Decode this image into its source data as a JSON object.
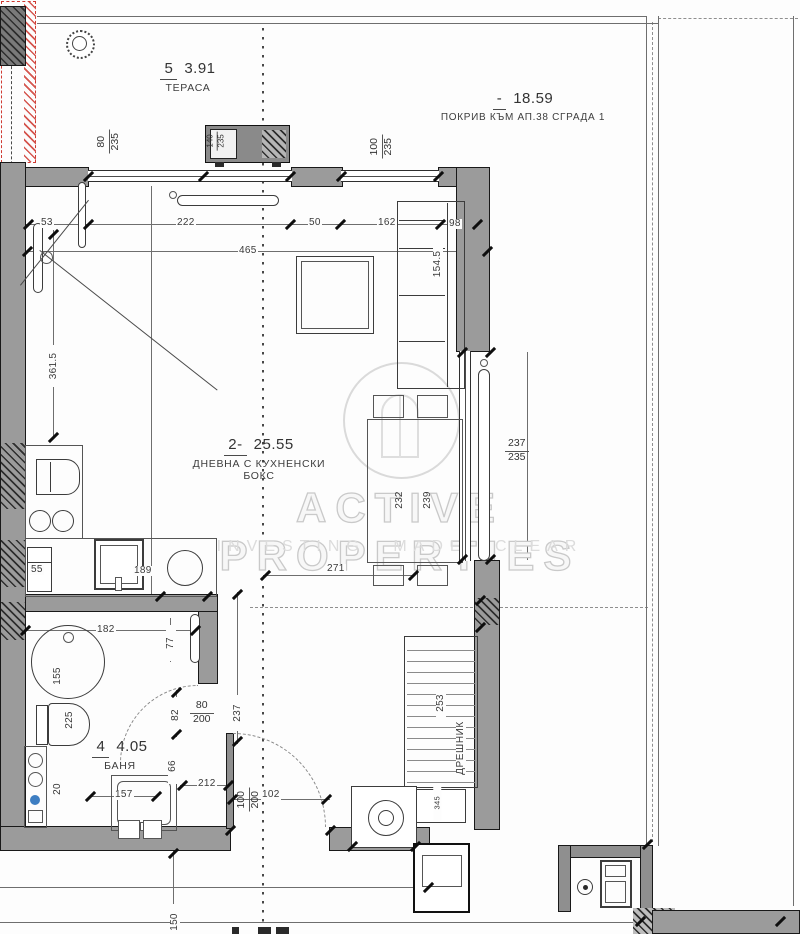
{
  "watermark": {
    "line1": "ACTIVE PROPERTIES",
    "line2": "INVESTING MADE CLEAR"
  },
  "rooms": {
    "terrace": {
      "num": "5",
      "area": "3.91",
      "name": "ТЕРАСА"
    },
    "roof": {
      "num": "-",
      "area": "18.59",
      "name": "ПОКРИВ КЪМ АП.38 СГРАДА 1"
    },
    "living": {
      "num": "2-",
      "area": "25.55",
      "name": "ДНЕВНА С КУХНЕНСКИ БОКС"
    },
    "bath": {
      "num": "4",
      "area": "4.05",
      "name": "БАНЯ"
    },
    "closet": {
      "name": "ДРЕШНИК"
    }
  },
  "fractions": {
    "terrace_door": {
      "n": "80",
      "d": "235"
    },
    "terrace_window": {
      "n": "140",
      "d": "235"
    },
    "top_window": {
      "n": "100",
      "d": "235"
    },
    "right_window": {
      "n": "237",
      "d": "235"
    },
    "bath_door": {
      "n": "80",
      "d": "200"
    },
    "entry_door": {
      "n": "100",
      "d": "200"
    }
  },
  "dims": {
    "d53": "53",
    "d222": "222",
    "d50": "50",
    "d162": "162",
    "d98": "98",
    "d465": "465",
    "d361_5": "361.5",
    "d154_5": "154.5",
    "d232": "232",
    "d239": "239",
    "d271": "271",
    "d189": "189",
    "d55": "55",
    "d182": "182",
    "d77": "77",
    "d155": "155",
    "d225": "225",
    "d20": "20",
    "d157": "157",
    "d66": "66",
    "d212": "212",
    "d82": "82",
    "d237": "237",
    "d102": "102",
    "d150": "150",
    "d253": "253",
    "d345": "345"
  }
}
